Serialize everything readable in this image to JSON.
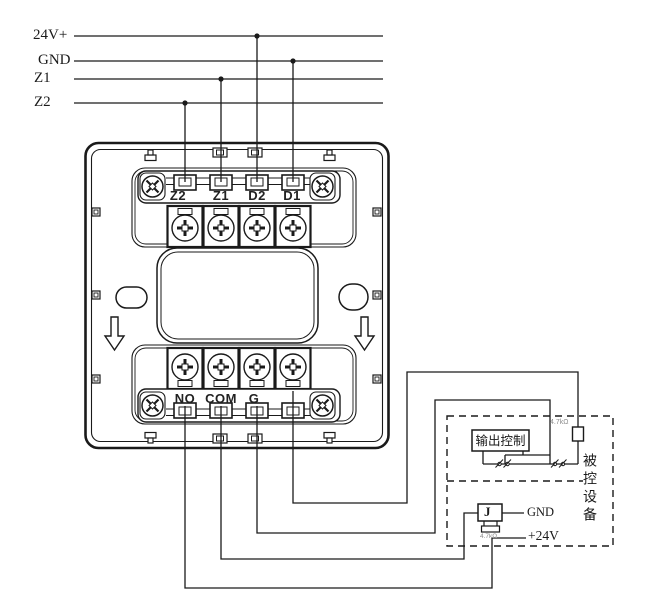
{
  "bus": {
    "labels": [
      "24V+",
      "GND",
      "Z1",
      "Z2"
    ]
  },
  "module": {
    "top_terminals": [
      "Z2",
      "Z1",
      "D2",
      "D1"
    ],
    "bottom_terminals": [
      "NO",
      "COM",
      "G",
      ""
    ]
  },
  "controlled_device": {
    "output_control": "输出控制",
    "label_vertical": "被控设备",
    "eol_resistor": "4.7kΩ"
  },
  "relay": {
    "designator": "J",
    "shunt_resistor": "4.7kΩ"
  },
  "power": {
    "gnd": "GND",
    "v24": "+24V"
  },
  "colors": {
    "line": "#1a1a1a",
    "background": "#ffffff",
    "faint_label": "#8a8a8a"
  }
}
